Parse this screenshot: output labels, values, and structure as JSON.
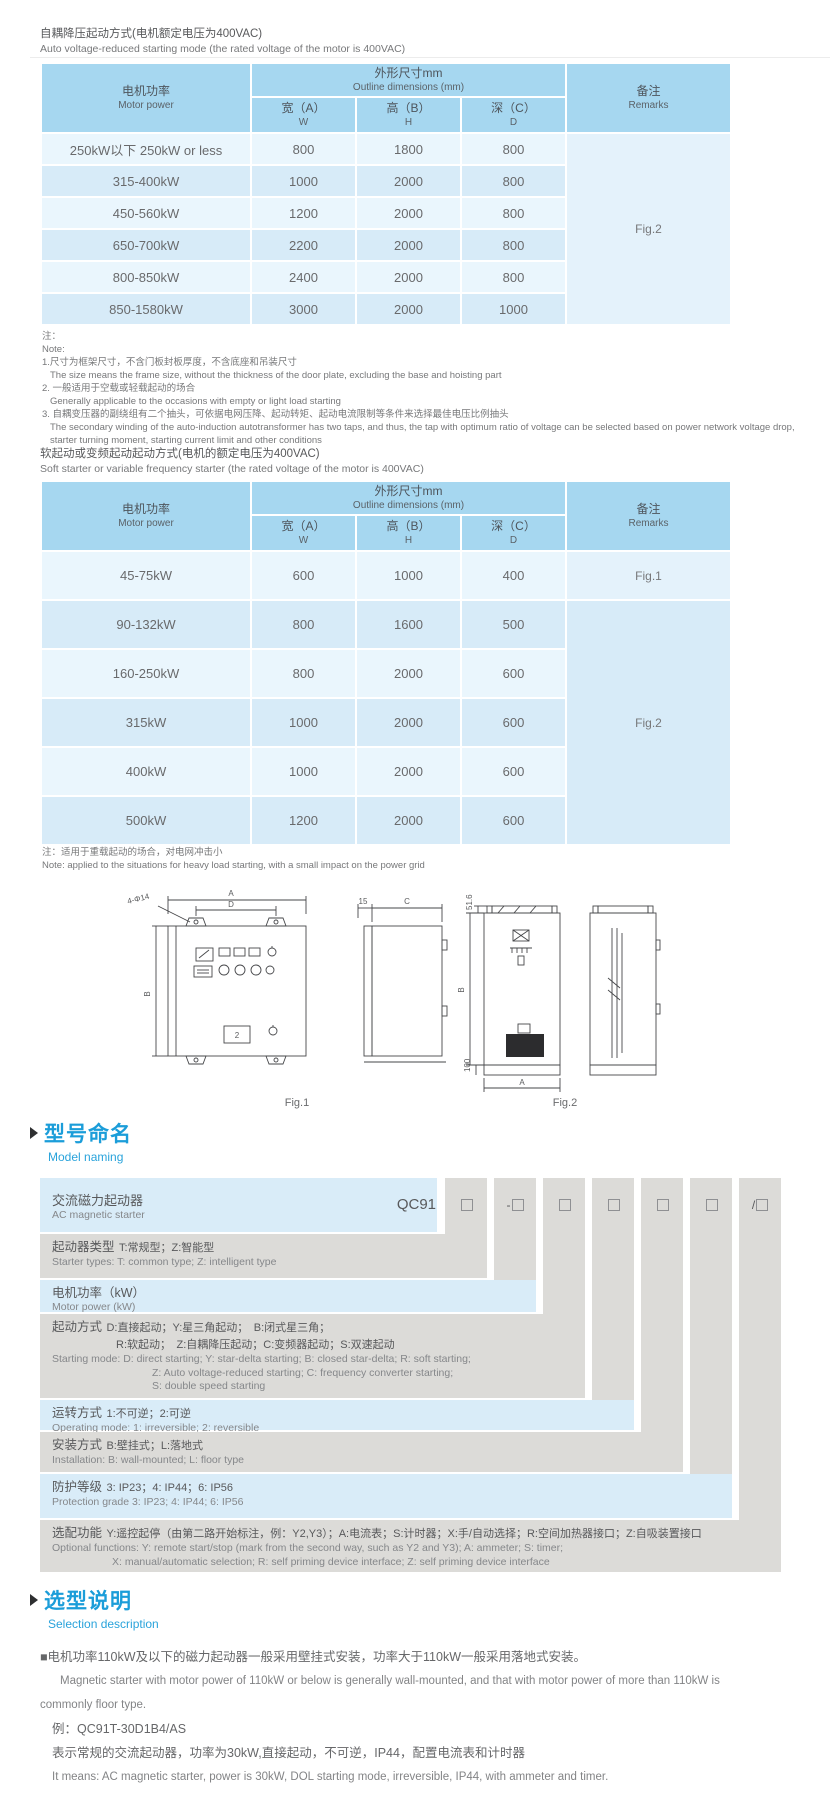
{
  "colors": {
    "header_blue": "#a6d7f0",
    "row_light": "#eaf6fd",
    "row_dark": "#d7ebf8",
    "model_blue": "#d9ecf8",
    "model_gray": "#dcdbd8",
    "heading_blue": "#1b9dd9"
  },
  "dim_table_headers": {
    "motor_zh": "电机功率",
    "motor_en": "Motor power",
    "dims_zh": "外形尺寸mm",
    "dims_en": "Outline dimensions (mm)",
    "w_zh": "宽（A）",
    "w_en": "W",
    "h_zh": "高（B）",
    "h_en": "H",
    "d_zh": "深（C）",
    "d_en": "D",
    "remark_zh": "备注",
    "remark_en": "Remarks"
  },
  "table1": {
    "title_zh": "自耦降压起动方式(电机额定电压为400VAC)",
    "title_en": "Auto voltage-reduced starting mode (the rated voltage of the motor is 400VAC)",
    "rows": [
      {
        "power": "250kW以下 250kW or less",
        "w": "800",
        "h": "1800",
        "d": "800",
        "remark": "Fig.2",
        "remark_span": 6
      },
      {
        "power": "315-400kW",
        "w": "1000",
        "h": "2000",
        "d": "800"
      },
      {
        "power": "450-560kW",
        "w": "1200",
        "h": "2000",
        "d": "800"
      },
      {
        "power": "650-700kW",
        "w": "2200",
        "h": "2000",
        "d": "800"
      },
      {
        "power": "800-850kW",
        "w": "2400",
        "h": "2000",
        "d": "800"
      },
      {
        "power": "850-1580kW",
        "w": "3000",
        "h": "2000",
        "d": "1000"
      }
    ]
  },
  "note1": {
    "label_zh": "注：",
    "label_en": "Note:",
    "item1_zh": "1.尺寸为框架尺寸，不含门板封板厚度，不含底座和吊装尺寸",
    "item1_en": "The size means the frame size, without the thickness of the door plate, excluding the base and hoisting part",
    "item2_zh": "2. 一般适用于空载或轻载起动的场合",
    "item2_en": "Generally applicable to the occasions with empty or light load starting",
    "item3_zh": "3. 自耦变压器的副绕组有二个抽头，可依据电网压降、起动转矩、起动电流限制等条件来选择最佳电压比例抽头",
    "item3_en1": "The secondary winding of the auto-induction autotransformer has two taps, and thus, the tap with optimum ratio of voltage can be selected based on power network voltage drop,",
    "item3_en2": "starter turning moment, starting current limit and other conditions"
  },
  "table2": {
    "title_zh": "软起动或变频起动起动方式(电机的额定电压为400VAC)",
    "title_en": "Soft starter or variable frequency starter (the rated voltage of the motor is 400VAC)",
    "rows": [
      {
        "power": "45-75kW",
        "w": "600",
        "h": "1000",
        "d": "400",
        "remark": "Fig.1",
        "remark_span": 1
      },
      {
        "power": "90-132kW",
        "w": "800",
        "h": "1600",
        "d": "500",
        "remark": "Fig.2",
        "remark_span": 5
      },
      {
        "power": "160-250kW",
        "w": "800",
        "h": "2000",
        "d": "600"
      },
      {
        "power": "315kW",
        "w": "1000",
        "h": "2000",
        "d": "600"
      },
      {
        "power": "400kW",
        "w": "1000",
        "h": "2000",
        "d": "600"
      },
      {
        "power": "500kW",
        "w": "1200",
        "h": "2000",
        "d": "600"
      }
    ]
  },
  "note2": {
    "zh": "注：适用于重载起动的场合，对电网冲击小",
    "en": "Note: applied to the situations for heavy load starting, with a small impact on the power grid"
  },
  "figures": {
    "fig1": {
      "caption": "Fig.1",
      "dim_a": "A",
      "dim_d": "D",
      "holes": "4-Φ14",
      "dim_b": "B",
      "panel_num": "2",
      "dim_off": "15",
      "dim_c": "C"
    },
    "fig2": {
      "caption": "Fig.2",
      "dim_top": "51.6",
      "dim_b": "B",
      "dim_base": "100",
      "dim_a": "A"
    }
  },
  "model_naming": {
    "heading_zh": "型号命名",
    "heading_en": "Model naming",
    "code_prefix": "QC91",
    "slots": [
      {
        "prefix": ""
      },
      {
        "prefix": "-"
      },
      {
        "prefix": ""
      },
      {
        "prefix": ""
      },
      {
        "prefix": ""
      },
      {
        "prefix": ""
      },
      {
        "prefix": "/"
      }
    ],
    "rows": [
      {
        "zh": "交流磁力起动器",
        "en": "AC magnetic starter"
      },
      {
        "term": "起动器类型",
        "desc": "T:常规型；Z:智能型",
        "en": "Starter types: T: common type; Z: intelligent type"
      },
      {
        "term": "电机功率（kW）",
        "en": "Motor power (kW)"
      },
      {
        "term": "起动方式",
        "desc": "D:直接起动；Y:星三角起动；　B:闭式星三角；",
        "desc2": "R:软起动；　Z:自耦降压起动；C:变频器起动；S:双速起动",
        "en": "Starting mode: D: direct starting; Y: star-delta starting; B: closed star-delta; R: soft starting;",
        "en2": "Z: Auto voltage-reduced starting; C: frequency converter starting;",
        "en3": "S: double speed starting"
      },
      {
        "term": "运转方式",
        "desc": "1:不可逆；2:可逆",
        "en": "Operating mode: 1: irreversible; 2: reversible"
      },
      {
        "term": "安装方式",
        "desc": "B:壁挂式；L:落地式",
        "en": "Installation: B: wall-mounted; L: floor type"
      },
      {
        "term": "防护等级",
        "desc": "3: IP23；4: IP44；6: IP56",
        "en": "Protection grade 3: IP23; 4: IP44; 6: IP56"
      },
      {
        "term": "选配功能",
        "desc": "Y:遥控起停（由第二路开始标注，例：Y2,Y3）；A:电流表；S:计时器；X:手/自动选择；R:空间加热器接口；Z:自吸装置接口",
        "en": "Optional functions: Y: remote start/stop (mark from the second way, such as Y2 and Y3); A: ammeter; S: timer;",
        "en2": "X: manual/automatic selection; R: self priming device interface; Z: self priming device interface"
      }
    ]
  },
  "selection": {
    "heading_zh": "选型说明",
    "heading_en": "Selection description",
    "p1_zh": "■电机功率110kW及以下的磁力起动器一般采用壁挂式安装，功率大于110kW一般采用落地式安装。",
    "p1_en1": "Magnetic starter with motor power of 110kW or below is generally wall-mounted, and that with motor power of more than 110kW is",
    "p1_en2": "commonly floor type.",
    "example": "例：QC91T-30D1B4/AS",
    "example_zh": "表示常规的交流起动器，功率为30kW,直接起动，不可逆，IP44，配置电流表和计时器",
    "example_en": "It means: AC magnetic starter, power is 30kW, DOL starting mode, irreversible, IP44, with ammeter and timer."
  }
}
